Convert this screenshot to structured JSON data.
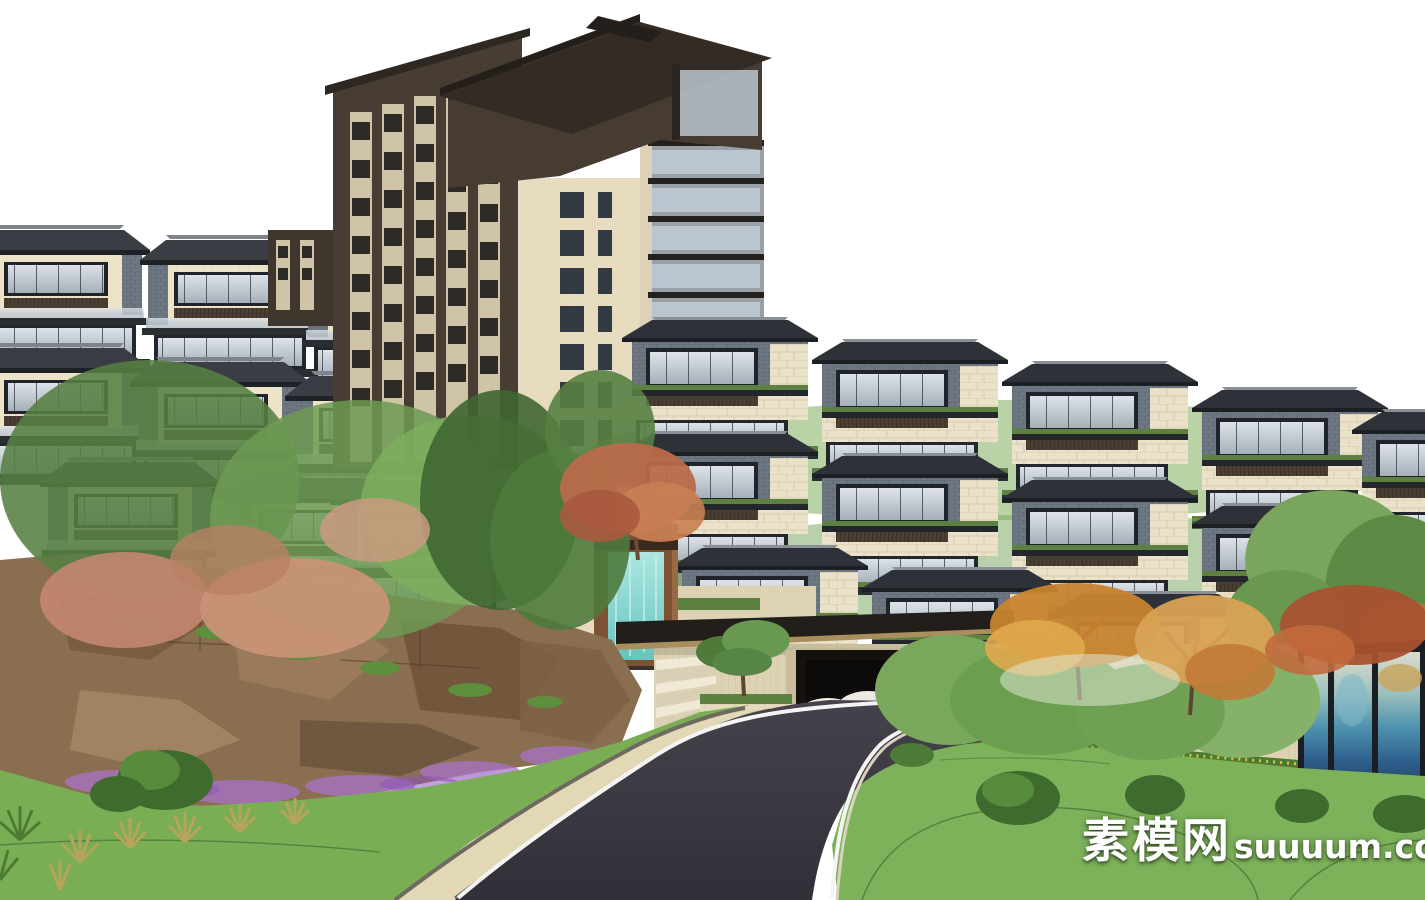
{
  "image": {
    "type": "3D architectural rendering (SketchUp-style massing model)",
    "subject": "Hillside residential complex: terraced Chinese-modern apartment rows, a cream high-rise tower with dark brown crown, rocky landscaped slope, entrance gate with canopy and waterfall wall, curved asphalt road with lawns and gardens, landscape-painting art wall"
  },
  "watermark": {
    "cn": "素模网",
    "en": "suuuum.com",
    "full": "素模网suuuum.com",
    "color": "#ffffff"
  },
  "entrance": {
    "sign_text": "龙琴",
    "sign_color": "#241a10",
    "description": "dark calligraphy project-name sign on cream slatted entrance wall, partly hidden by tree"
  },
  "palette": {
    "sky": "#ffffff",
    "tower_cream": "#e7dcc0",
    "roof_dark_brown": "#473c31",
    "slate_cladding": "#6e7883",
    "cream_stone": "#eae2ca",
    "glass": "#c9d1d8",
    "lawn_green": "#79ae55",
    "hedge_green": "#5d8140",
    "road_asphalt": "#3c3842",
    "road_edge_line": "#f4f4f4",
    "sidewalk": "#e3d8b5",
    "rock_brown": "#8a6e50",
    "purple_flowers": "#a873c8",
    "water_teal": "#7fd0cb",
    "copper_frame": "#7d5134",
    "autumn_orange": "#c8842f",
    "salmon_foliage": "#c28570",
    "art_wall_blue": "#4f93ae"
  },
  "scene": {
    "elements": [
      {
        "name": "sky",
        "label": "white background sky"
      },
      {
        "name": "left-apartment-cluster",
        "label": "terraced apartments on left hill behind trees"
      },
      {
        "name": "highrise-tower",
        "label": "high-rise tower, cream body, dark brown crown, side balconies"
      },
      {
        "name": "right-terraced-houses",
        "label": "stepped terrace townhouses descending to the right"
      },
      {
        "name": "hillside-rocks",
        "label": "brown rock retaining cliff with grasses and purple flowers"
      },
      {
        "name": "waterfall-feature",
        "label": "copper-framed waterfall wall with teal water"
      },
      {
        "name": "entrance-gate",
        "label": "entrance wall with dark canopy, steps, bonsai planter, totem and white stone sculpture"
      },
      {
        "name": "art-wall",
        "label": "framed blue landscape-painting panels"
      },
      {
        "name": "garden",
        "label": "lawns, clipped shrub domes, green and autumn trees"
      },
      {
        "name": "road",
        "label": "S-curved dark asphalt road with white edge lines and paver sidewalk"
      },
      {
        "name": "watermark",
        "label": "white site watermark bottom right"
      }
    ]
  }
}
